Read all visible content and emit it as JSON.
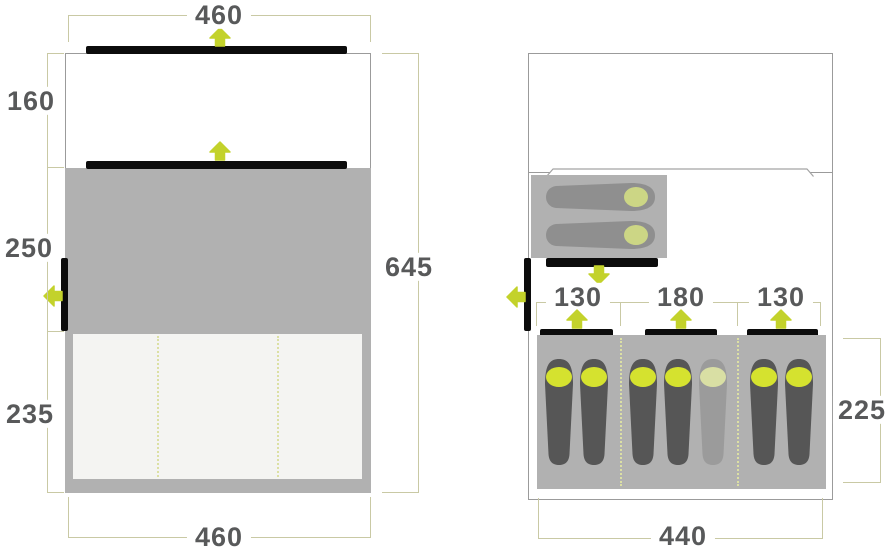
{
  "colors": {
    "accent": "#c3d22b",
    "bag_head": "#d5e22f",
    "bag_head_faded": "#d9dfa4",
    "bag_head_pale": "#ccd685",
    "bag_body": "#565656",
    "bag_body_faded": "#9b9b9b",
    "bag_body_top": "#8f8f8f",
    "area_gray": "#b1b1b1",
    "inner_light": "#f4f4f2",
    "dim_line": "#c9c9a4",
    "dotted_divider": "#dce0a4",
    "label_text": "#58595a",
    "door_black": "#0c0c0c",
    "outline": "#9b9b9b"
  },
  "icons": {
    "arrow_up": "arrow-up-icon",
    "arrow_down": "arrow-down-icon",
    "arrow_left": "arrow-left-icon",
    "sleeping_bag": "sleeping-bag-icon"
  },
  "left_diagram": {
    "top_width": "460",
    "section_depths": [
      "160",
      "250",
      "235"
    ],
    "total_depth": "645",
    "bottom_width": "460"
  },
  "right_diagram": {
    "cabin_widths": [
      "130",
      "180",
      "130"
    ],
    "sleeping_depth": "225",
    "bottom_width": "440",
    "bottom_sleeping_bags": 7,
    "faded_bag_index": 4,
    "top_sleeping_bags": 2
  }
}
